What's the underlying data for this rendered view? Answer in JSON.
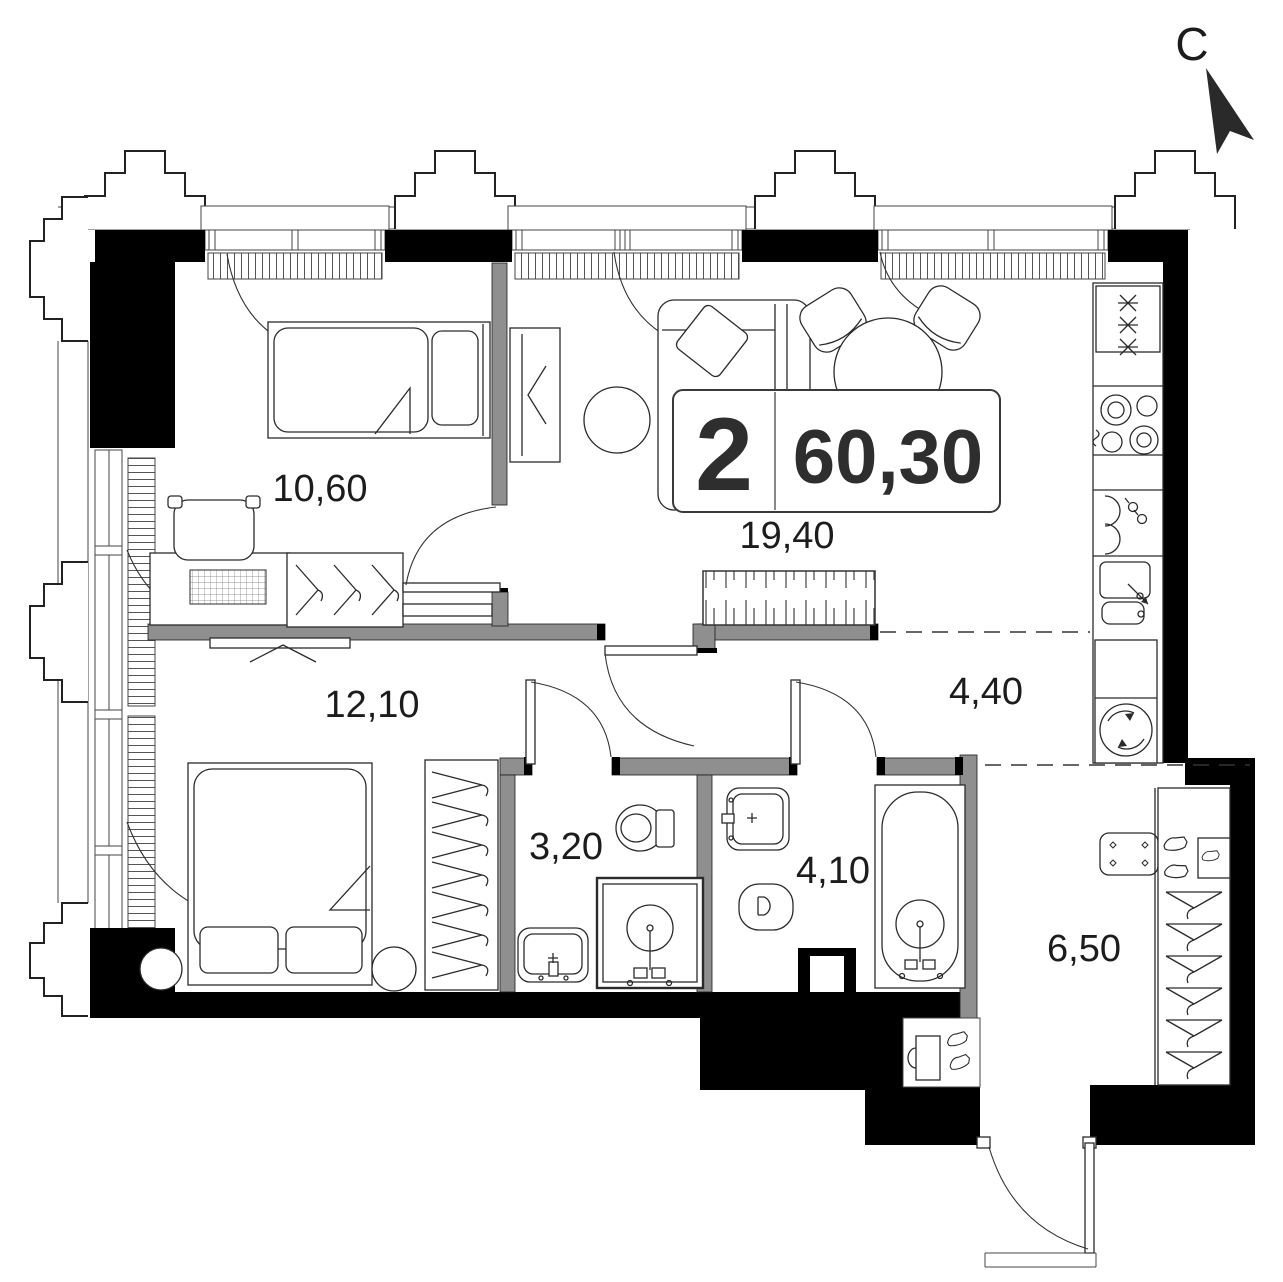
{
  "plan": {
    "type": "apartment-floor-plan",
    "north_label": "С",
    "info_box": {
      "room_count": "2",
      "total_area": "60,30"
    },
    "rooms": [
      {
        "id": "bedroom-1",
        "area": "10,60"
      },
      {
        "id": "living-room",
        "area": "19,40"
      },
      {
        "id": "bedroom-2",
        "area": "12,10"
      },
      {
        "id": "corridor",
        "area": "4,40"
      },
      {
        "id": "bathroom-1",
        "area": "3,20"
      },
      {
        "id": "bathroom-2",
        "area": "4,10"
      },
      {
        "id": "entrance-hall",
        "area": "6,50"
      }
    ],
    "colors": {
      "wall": "#000000",
      "partition": "#8f8f8f",
      "line": "#2b2b2b",
      "background": "#ffffff"
    }
  }
}
